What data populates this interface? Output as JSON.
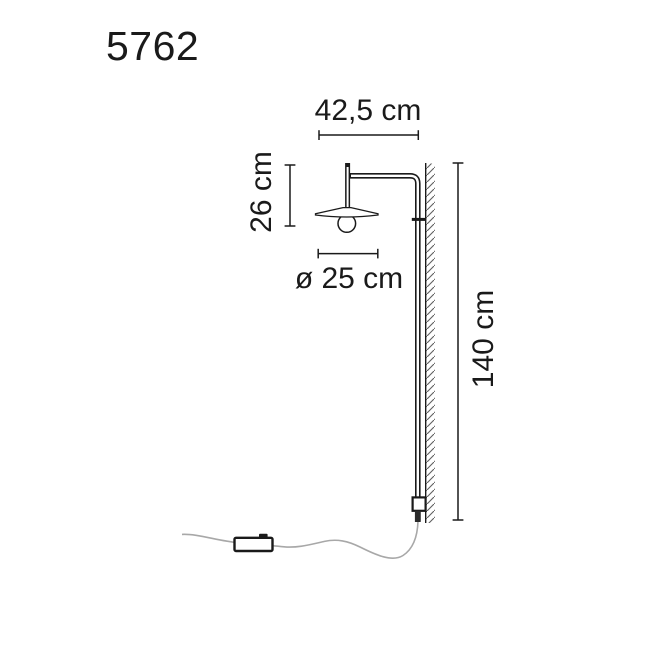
{
  "model": {
    "number": "5762"
  },
  "dimensions": {
    "arm_width": "42,5 cm",
    "head_height": "26 cm",
    "shade_diameter": "ø 25 cm",
    "total_height": "140 cm"
  },
  "colors": {
    "ink": "#1a1a1a",
    "cable": "#a8a8a8",
    "background": "#ffffff",
    "hatch": "#606060"
  }
}
